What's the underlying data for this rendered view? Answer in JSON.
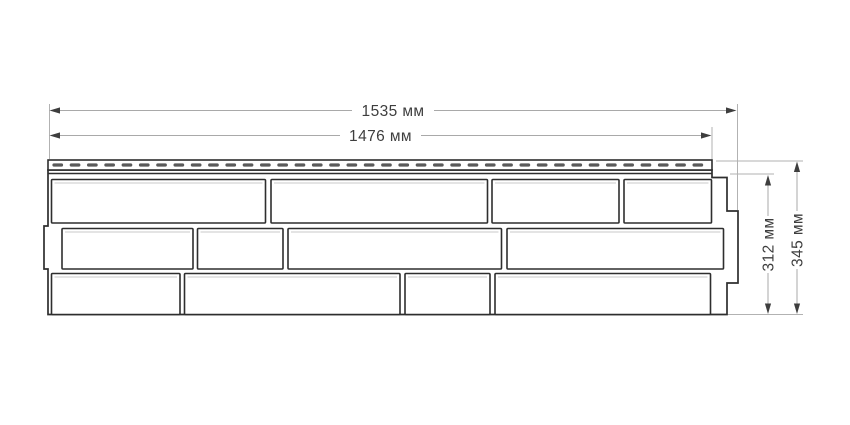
{
  "page": {
    "background_color": "#ffffff"
  },
  "drawing": {
    "kind": "product-dimension-drawing",
    "subject": "facade siding panel, front view, stone/brick pattern",
    "panel": {
      "stone_rows": 3,
      "stones_per_row": 4,
      "has_perforated_nail_strip": true
    },
    "dimensions": {
      "total_width": "1535 мм",
      "nail_strip_width": "1476 мм",
      "body_height": "312 мм",
      "total_height": "345 мм"
    },
    "colors": {
      "outline": "#2e2e2e",
      "dimension_line": "#a9a9a9",
      "extension_line": "#b2b2b2",
      "arrow_and_text": "#3e3e3e",
      "perforation_dash": "#5a5a5a",
      "background": "#ffffff"
    }
  }
}
